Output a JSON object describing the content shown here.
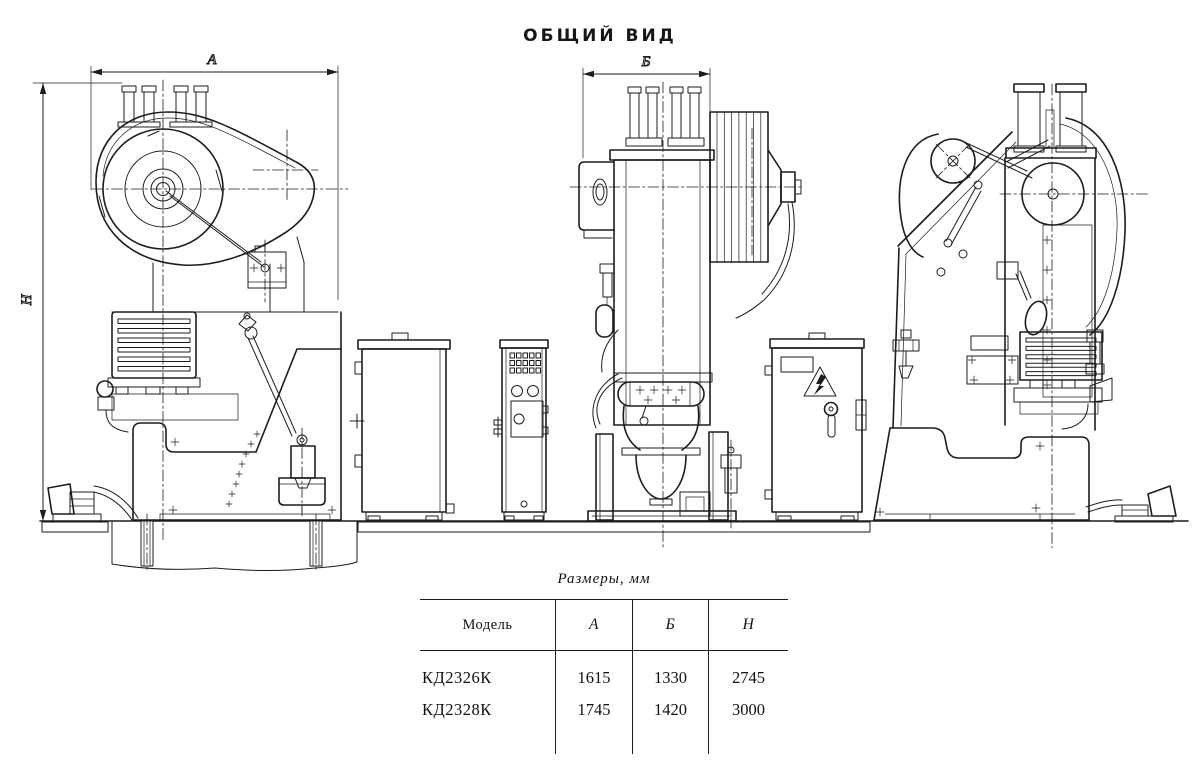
{
  "title": "ОБЩИЙ ВИД",
  "drawing": {
    "dim_a": "А",
    "dim_b": "Б",
    "dim_h": "Н"
  },
  "table": {
    "caption": "Размеры,  мм",
    "headers": [
      "Модель",
      "А",
      "Б",
      "Н"
    ],
    "rows": [
      {
        "cells": [
          "КД2326К",
          "1615",
          "1330",
          "2745"
        ]
      },
      {
        "cells": [
          "КД2328К",
          "1745",
          "1420",
          "3000"
        ]
      }
    ]
  }
}
